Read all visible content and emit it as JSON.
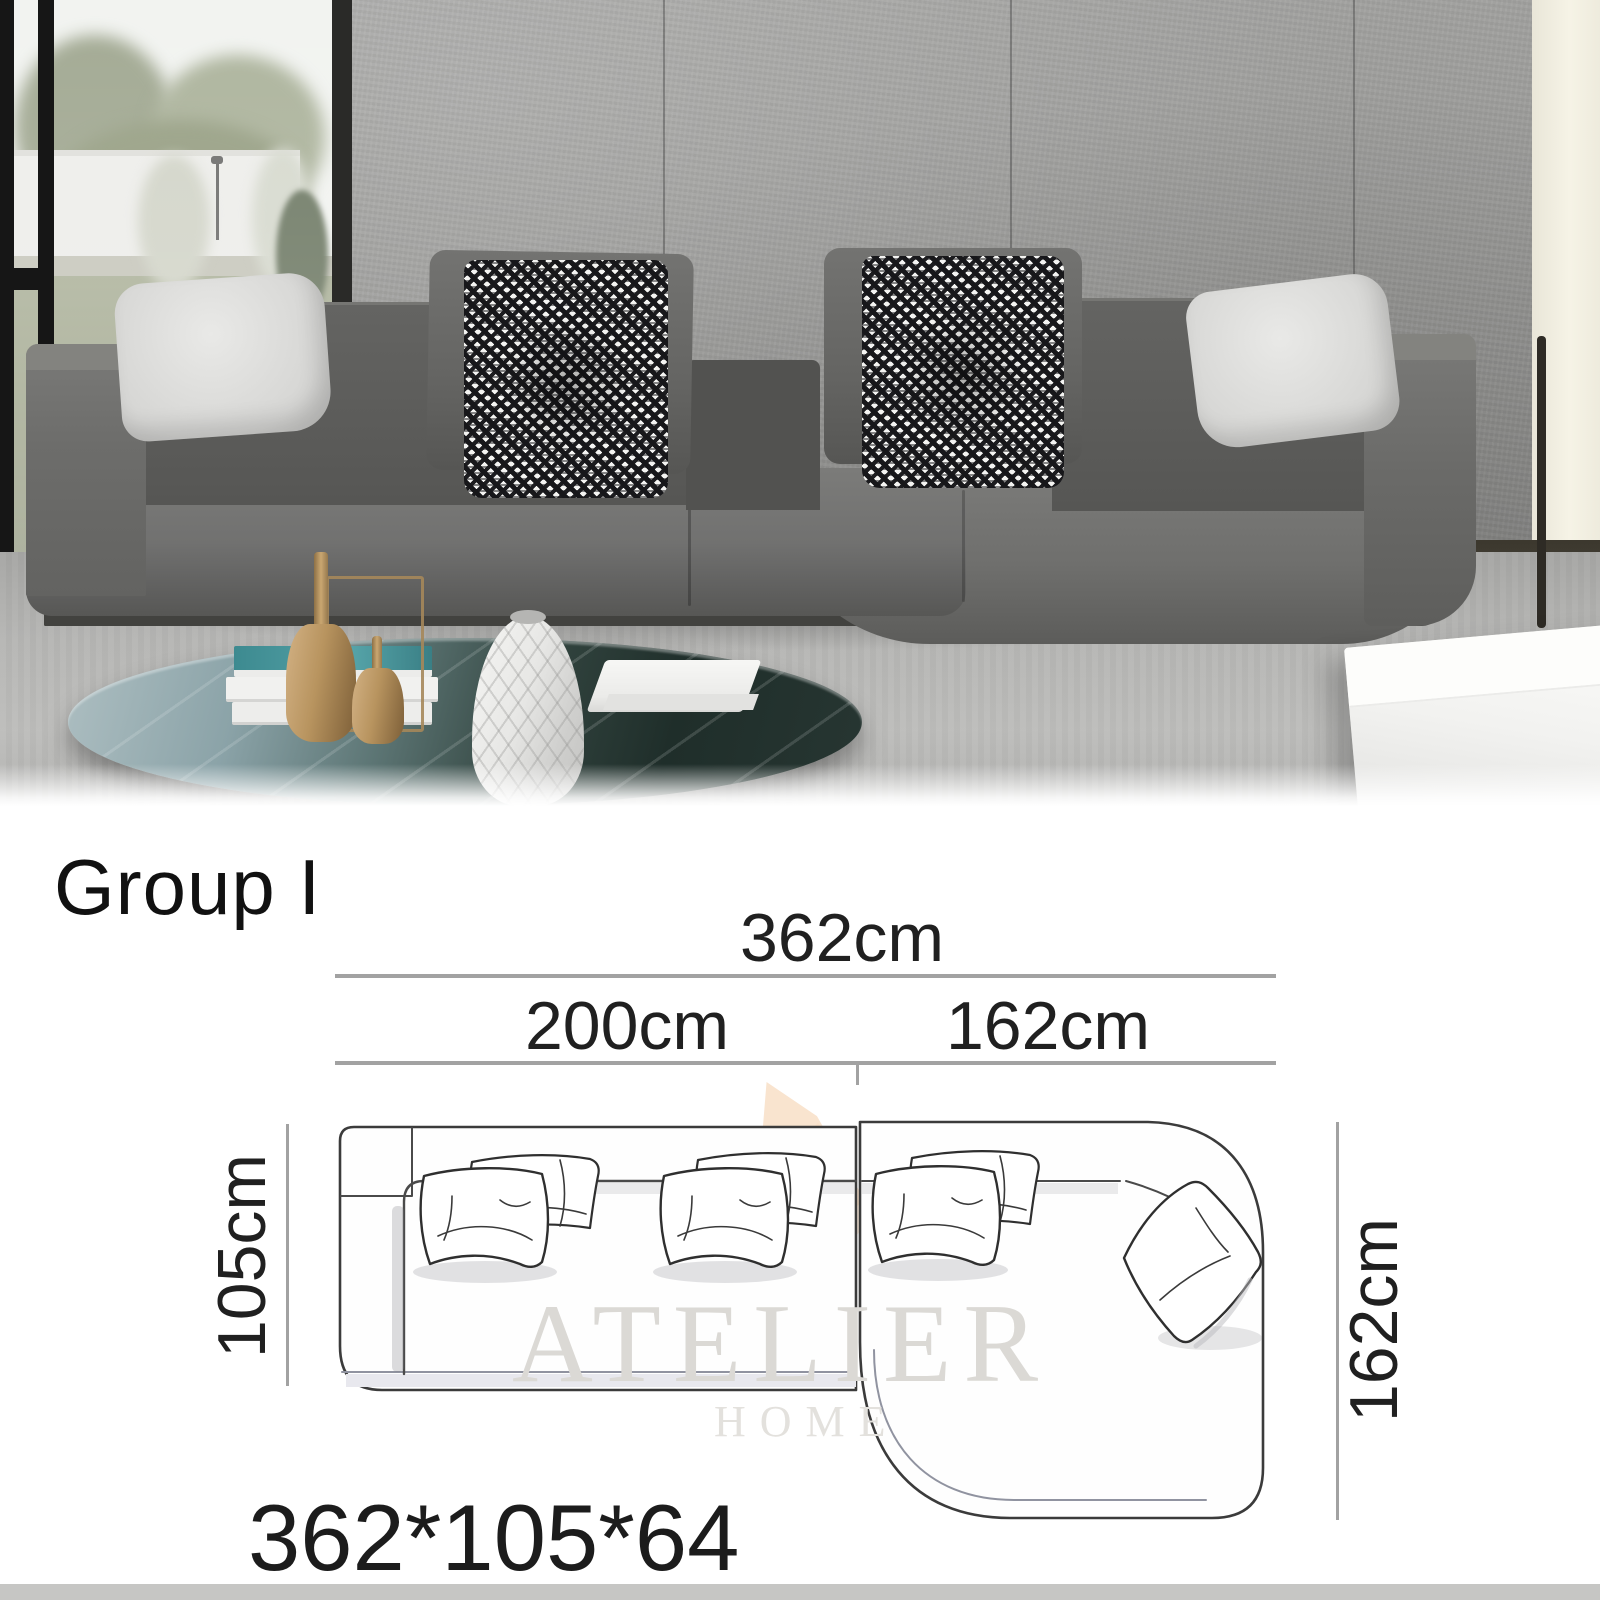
{
  "photo": {
    "description": "gray fabric L-shaped sectional sofa in concrete-wall living room",
    "colors": {
      "sofa": "#5f5f5d",
      "wall": "#979795",
      "rug": "#b4b4b2",
      "gold_accent": "#c3a06b",
      "table_marble": "#2f3e3a",
      "curtain": "#f1eee2"
    }
  },
  "board": {
    "group_label": "Group I",
    "overall_size": "362*105*64",
    "dimensions": {
      "total_width": "362cm",
      "left_width": "200cm",
      "right_width": "162cm",
      "left_depth": "105cm",
      "chaise_depth": "162cm"
    },
    "watermark": {
      "line1": "ATELIER",
      "line2": "HOME",
      "accent_color": "#f0c89a"
    }
  }
}
